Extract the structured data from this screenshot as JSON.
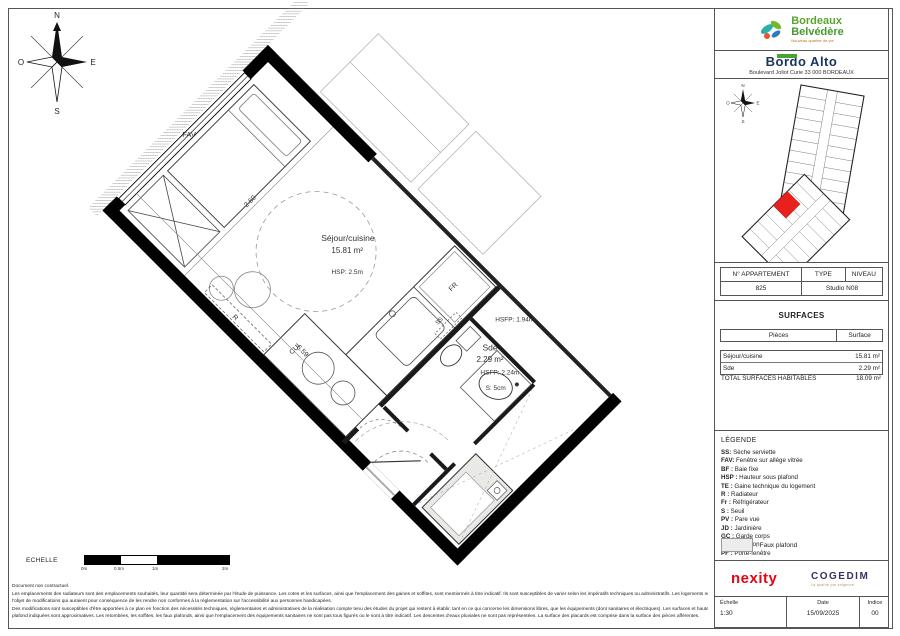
{
  "brand": {
    "line1": "Bordeaux",
    "line2": "Belvédère",
    "tagline": "Nouveau quartier de vie"
  },
  "project": {
    "name": "Bordo Alto",
    "address": "Boulevard Joliot Curie 33 000 BORDEAUX"
  },
  "compass": {
    "n": "N",
    "s": "S",
    "e": "E",
    "o": "O"
  },
  "apartment": {
    "col_num": "N° APPARTEMENT",
    "col_type": "TYPE",
    "col_level": "NIVEAU",
    "num": "825",
    "type_level": "Studio N08"
  },
  "surfaces": {
    "title": "SURFACES",
    "col_room": "Pièces",
    "col_surface": "Surface",
    "rows": [
      {
        "room": "Séjour/cuisine",
        "surface": "15.81 m²"
      },
      {
        "room": "Sde",
        "surface": "2.29 m²"
      }
    ],
    "total_label": "TOTAL SURFACES HABITABLES",
    "total_value": "18.09 m²"
  },
  "legend": {
    "title": "LÉGENDE",
    "items": [
      {
        "abbr": "SS:",
        "label": "Sèche serviette"
      },
      {
        "abbr": "FAV:",
        "label": "Fenêtre sur allège vitrée"
      },
      {
        "abbr": "BF :",
        "label": "Baie fixe"
      },
      {
        "abbr": "HSP :",
        "label": "Hauteur sous plafond"
      },
      {
        "abbr": "TE :",
        "label": "Gaine technique du logement"
      },
      {
        "abbr": "R :",
        "label": "Radiateur"
      },
      {
        "abbr": "Fr :",
        "label": "Réfrigérateur"
      },
      {
        "abbr": "S :",
        "label": "Seuil"
      },
      {
        "abbr": "PV :",
        "label": "Pare vue"
      },
      {
        "abbr": "JD :",
        "label": "Jardinière"
      },
      {
        "abbr": "GC :",
        "label": "Garde corps"
      },
      {
        "abbr": "CUI :",
        "label": "Cuisson"
      },
      {
        "abbr": "PF :",
        "label": "Porte-fenêtre"
      }
    ],
    "swatch_label": ": Faux plafond"
  },
  "plan": {
    "fav": "FAV",
    "dim_width": "2.60",
    "dim_length": "6.59",
    "room1_name": "Séjour/cuisine",
    "room1_area": "15.81 m²",
    "room1_hsp": "HSP: 2.5m",
    "fr": "FR",
    "cui": "CUI",
    "ss": "SS",
    "radiator": "R",
    "hsfp1": "HSFP: 1.94m",
    "sde_name": "Sde",
    "sde_area": "2.29 m²",
    "hsfp2": "HSFP: 2.24m",
    "seuil": "S: 5cm"
  },
  "scalebar": {
    "label": "ECHELLE",
    "ticks": [
      "0m",
      "0.5m",
      "1m",
      "2m"
    ]
  },
  "logos": {
    "nexity": "nexity",
    "cogedim": "COGEDIM",
    "cogedim_tagline": "La qualité par exigence"
  },
  "titleblock": {
    "scale_label": "Échelle",
    "scale_value": "1:30",
    "date_label": "Date",
    "date_value": "15/09/2025",
    "index_label": "Indice",
    "index_value": "00"
  },
  "disclaimer": {
    "lines": [
      "Document non contractuel.",
      "Les emplacements des radiateurs sont des emplacements souhaités, leur quantité sera déterminée par l'étude de puissance. Les cotes et les surfaces, ainsi que l'emplacement des gaines et soffites, sont mentionnés à titre indicatif. Ils sont susceptibles de varier selon les impératifs techniques ou administratifs. Les logements ne peuvent faire",
      "l'objet de modifications qui auraient pour conséquence de les rendre non conformes à la réglementation sur l'accessibilité aux personnes handicapées.",
      "Des modifications sont susceptibles d'être apportées à ce plan en fonction des nécessités techniques, réglementaires et administratives de la réalisation compte tenu des études du projet qui restent à établir, tant en ce qui concerne les dimensions libres, que les équipements (dont sanitaires et électriques). Les surfaces et hauteurs sous",
      "plafond indiquées sont approximatives. Les retombées, les soffites, les faux plafonds, ainsi que l'emplacement des équipements sanitaires ne sont pas tous figurés ou le sont à titre indicatif. Les descentes d'eaux pluviales ne sont pas représentées. La surface des placards est comprise dans la surface des pièces afférentes."
    ]
  },
  "colors": {
    "brand_green": "#5aa32e",
    "unit_red": "#e8211d",
    "nexity_red": "#e30513",
    "cogedim_purple": "#3b2f66",
    "navy": "#17355e"
  }
}
